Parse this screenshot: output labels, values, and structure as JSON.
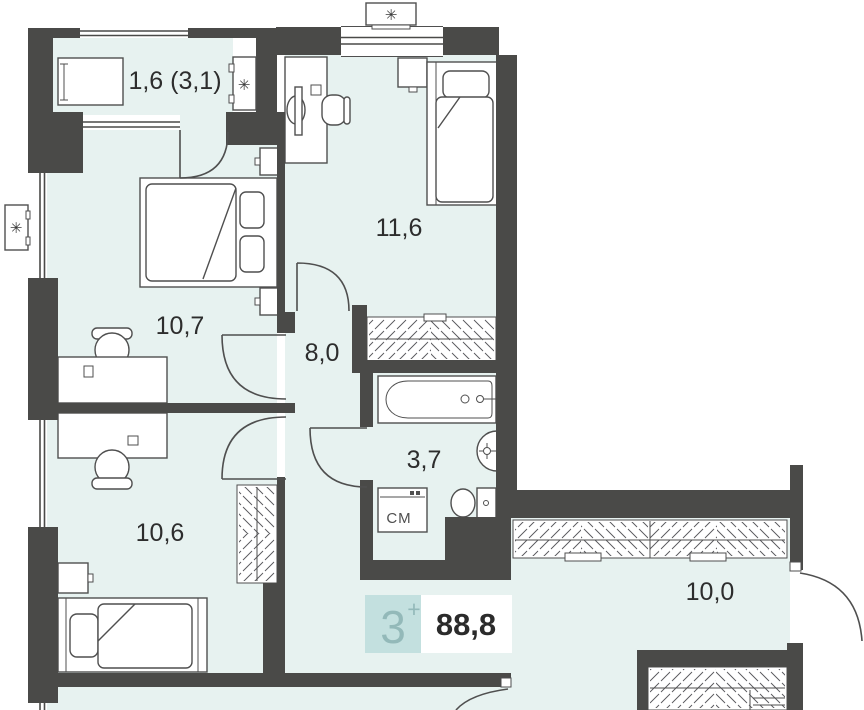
{
  "plan": {
    "badge": {
      "rooms": "3",
      "plus": "+",
      "total_area": "88,8"
    },
    "rooms": [
      {
        "id": "balcony",
        "label": "1,6 (3,1)"
      },
      {
        "id": "bedroom-top",
        "label": "11,6"
      },
      {
        "id": "bedroom-left",
        "label": "10,7"
      },
      {
        "id": "hallway",
        "label": "8,0"
      },
      {
        "id": "bathroom",
        "label": "3,7"
      },
      {
        "id": "bedroom-bottom",
        "label": "10,6"
      },
      {
        "id": "entry-hall",
        "label": "10,0"
      }
    ],
    "washer_label": "СМ",
    "ac_symbol": "✳",
    "colors": {
      "wall": "#4a4a48",
      "room_fill": "#e7f2f0",
      "outline": "#4f4f4f",
      "badge_bg": "#c3e0df",
      "badge_fg": "#93b9b9",
      "area_fg": "#2b2b2b"
    }
  }
}
